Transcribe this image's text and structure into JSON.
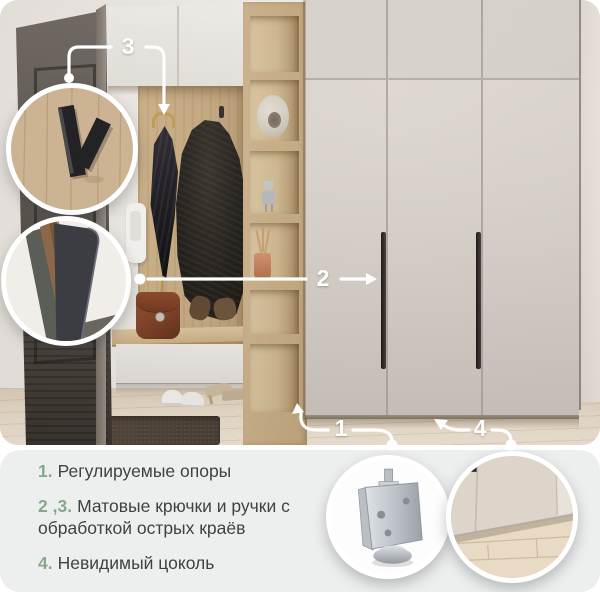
{
  "callouts": {
    "c1": "1",
    "c2": "2",
    "c3": "3",
    "c4": "4"
  },
  "features": [
    {
      "num": "1.",
      "text": "Регулируемые опоры"
    },
    {
      "num": "2 ,3.",
      "text": "Матовые крючки и ручки с обработкой острых краёв"
    },
    {
      "num": "4.",
      "text": "Невидимый цоколь"
    }
  ],
  "insets": [
    {
      "name": "matte-hook-closeup"
    },
    {
      "name": "handle-edge-closeup"
    },
    {
      "name": "adjustable-foot-closeup"
    },
    {
      "name": "invisible-plinth-closeup"
    }
  ],
  "colors": {
    "accent_green": "#86a88c",
    "panel_bg": "#edefee",
    "callout_white": "#ffffff",
    "wardrobe_beige": "#d6d0c9",
    "oak_wood": "#c6aa80",
    "text": "#3e4341"
  }
}
